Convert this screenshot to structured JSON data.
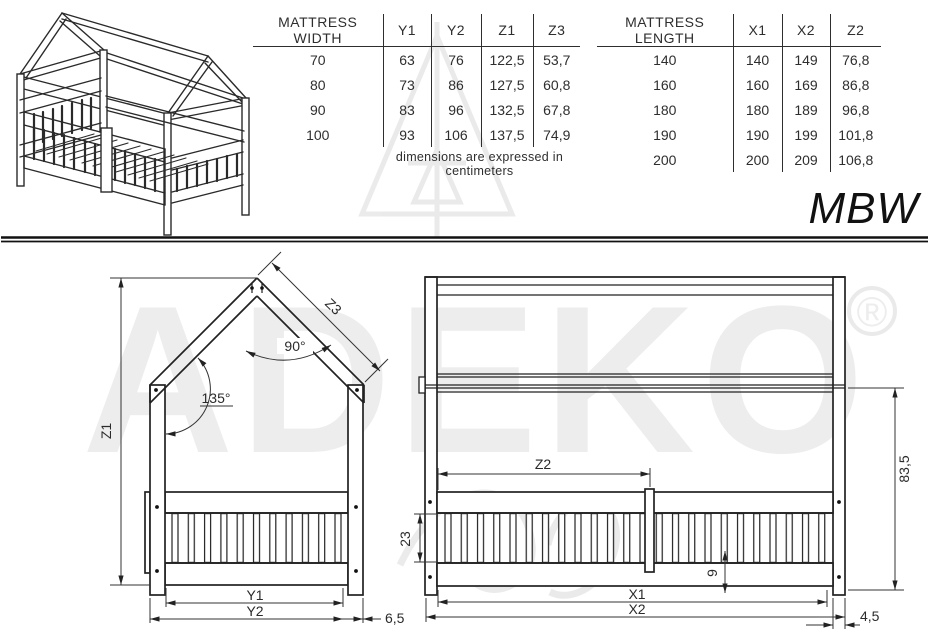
{
  "tables": {
    "width": {
      "headers": [
        "MATTRESS WIDTH",
        "Y1",
        "Y2",
        "Z1",
        "Z3"
      ],
      "rows": [
        [
          "70",
          "63",
          "76",
          "122,5",
          "53,7"
        ],
        [
          "80",
          "73",
          "86",
          "127,5",
          "60,8"
        ],
        [
          "90",
          "83",
          "96",
          "132,5",
          "67,8"
        ],
        [
          "100",
          "93",
          "106",
          "137,5",
          "74,9"
        ]
      ]
    },
    "length": {
      "headers": [
        "MATTRESS LENGTH",
        "X1",
        "X2",
        "Z2"
      ],
      "rows": [
        [
          "140",
          "140",
          "149",
          "76,8"
        ],
        [
          "160",
          "160",
          "169",
          "86,8"
        ],
        [
          "180",
          "180",
          "189",
          "96,8"
        ],
        [
          "190",
          "190",
          "199",
          "101,8"
        ],
        [
          "200",
          "200",
          "209",
          "106,8"
        ]
      ]
    },
    "note": "dimensions are expressed in centimeters"
  },
  "model": "MBW",
  "front_view": {
    "height_label": "Z1",
    "roof_slope_label": "Z3",
    "peak_angle": "90°",
    "eave_angle": "135°",
    "inner_width_label": "Y1",
    "outer_width_label": "Y2",
    "post_offset": "6,5"
  },
  "side_view": {
    "divider_distance_label": "Z2",
    "rail_height": "23",
    "base_offset": "9",
    "wall_height": "83,5",
    "inner_length_label": "X1",
    "outer_length_label": "X2",
    "post_offset": "4,5"
  },
  "watermark": {
    "brand": "ADEKO",
    "registered": "®"
  }
}
